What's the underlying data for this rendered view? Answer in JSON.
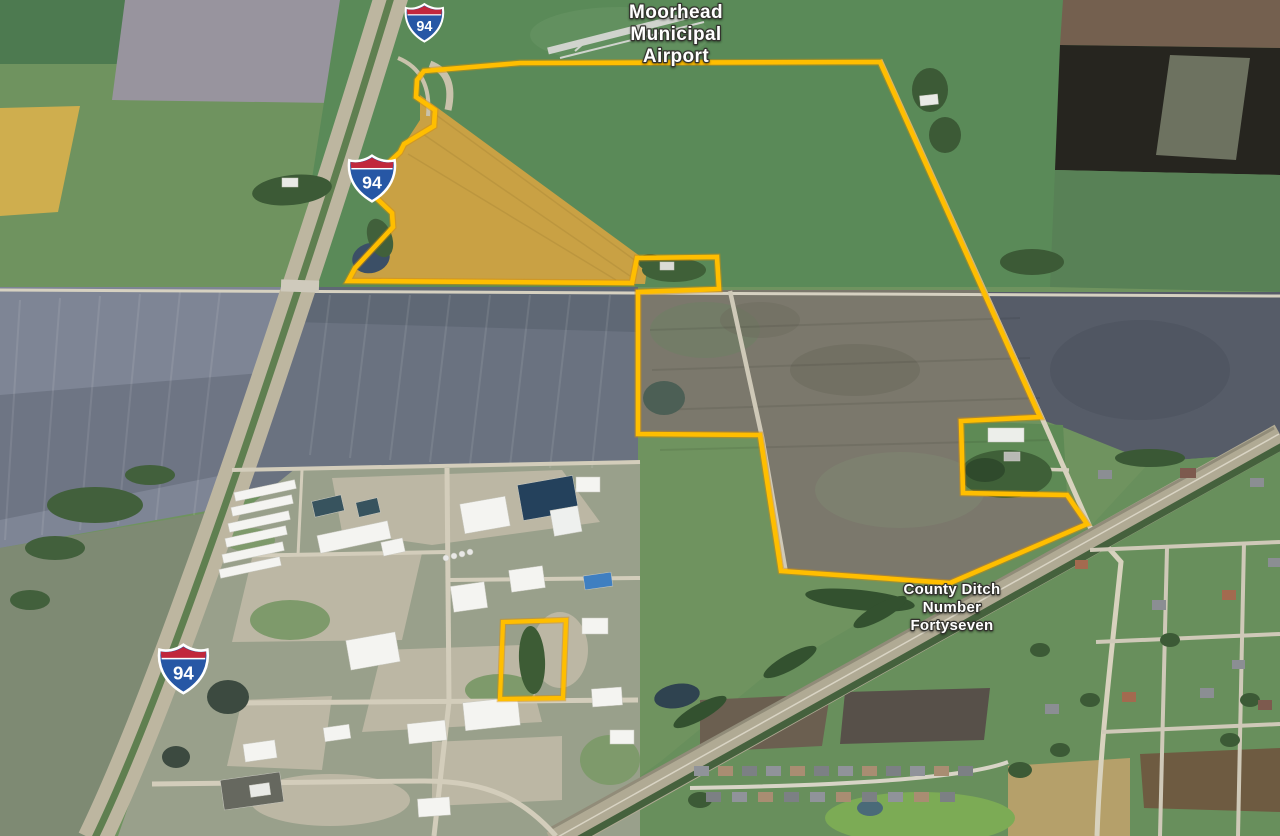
{
  "labels": {
    "airport": {
      "line1": "Moorhead",
      "line2": "Municipal",
      "line3": "Airport"
    },
    "ditch": {
      "line1": "County Ditch",
      "line2": "Number",
      "line3": "Fortyseven"
    },
    "interstate": {
      "number": "94"
    }
  },
  "colors": {
    "boundary_yellow": "#FFBE00",
    "boundary_edge": "#D98E00",
    "shield_blue": "#2757A5",
    "shield_red": "#C1273C",
    "label_white": "#FFFFFF"
  },
  "boundary": {
    "main_points": "424,71 520,63 880,62 1040,417 961,421 963,493 1067,495 1087,524 950,583 781,571 760,435 638,434 638,292 719,289 717,257 637,258 632,283 348,281 355,268 393,227 392,213 370,192 369,181 400,152 404,144 434,126 435,110 416,97 417,80",
    "small_parcel_points": "503,622 566,620 563,698 500,699"
  }
}
